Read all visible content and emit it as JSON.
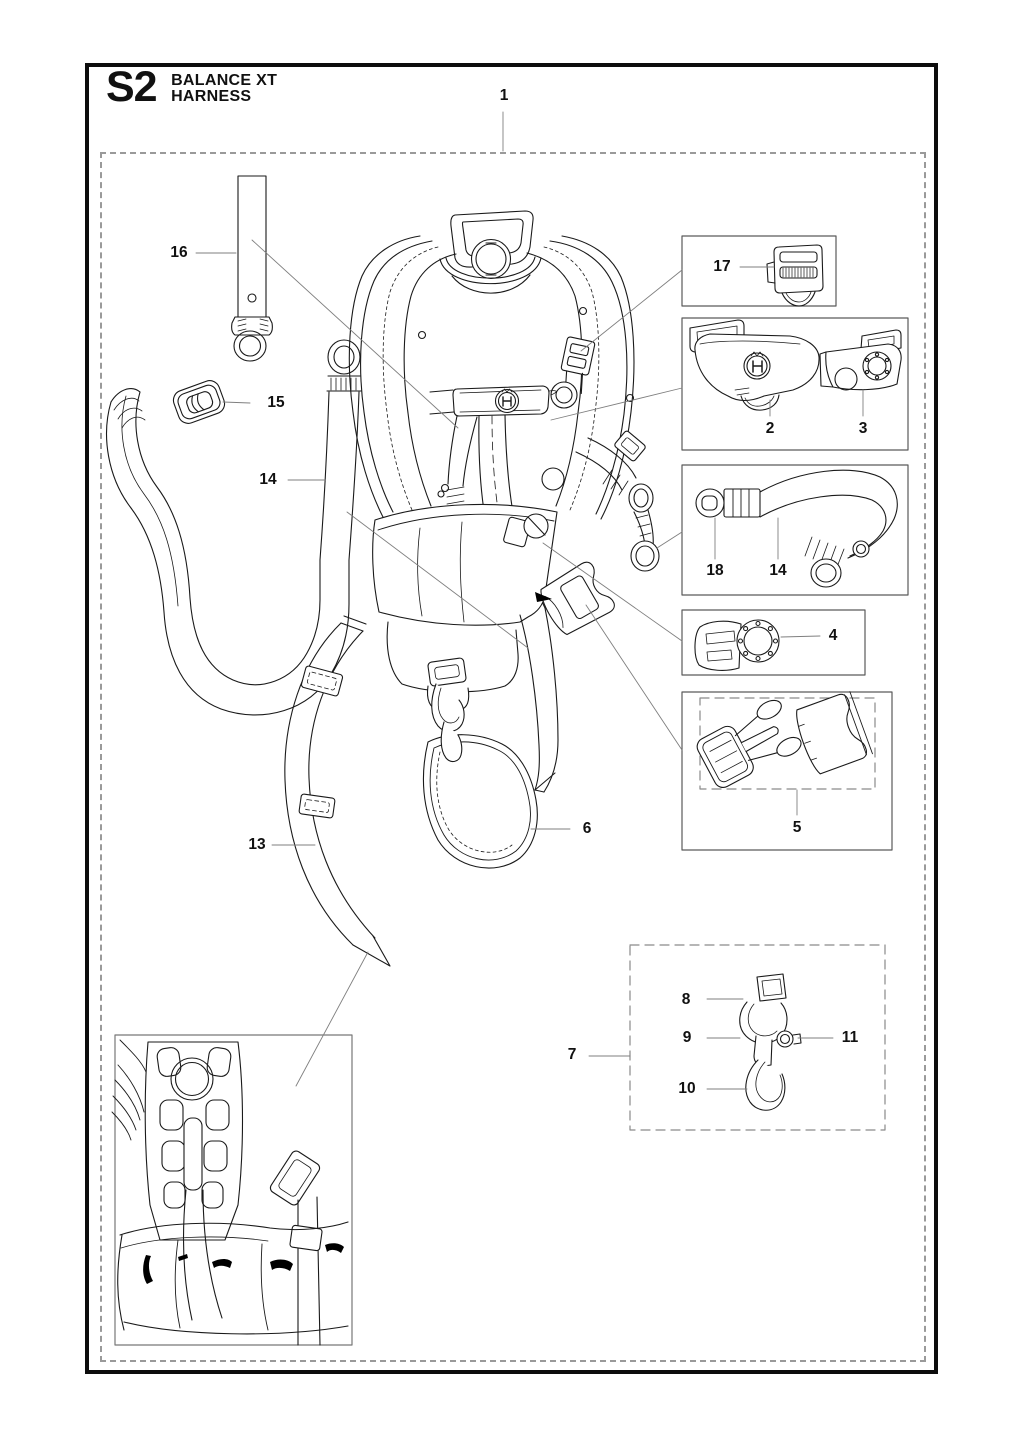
{
  "title": {
    "code": "S2",
    "model": "BALANCE XT",
    "part": "HARNESS"
  },
  "callouts": {
    "c1": "1",
    "c2": "2",
    "c3": "3",
    "c4": "4",
    "c5": "5",
    "c6": "6",
    "c7": "7",
    "c8": "8",
    "c9": "9",
    "c10": "10",
    "c11": "11",
    "c13": "13",
    "c14": "14",
    "c15": "15",
    "c16": "16",
    "c17": "17",
    "c18": "18"
  },
  "colors": {
    "line_art": "#1a1a1a",
    "leader_line": "#7f7f7f",
    "page_border": "#0d0d0d",
    "dashed_border": "#9a9a9a",
    "box_border": "#5a5a5a",
    "background": "#ffffff"
  }
}
